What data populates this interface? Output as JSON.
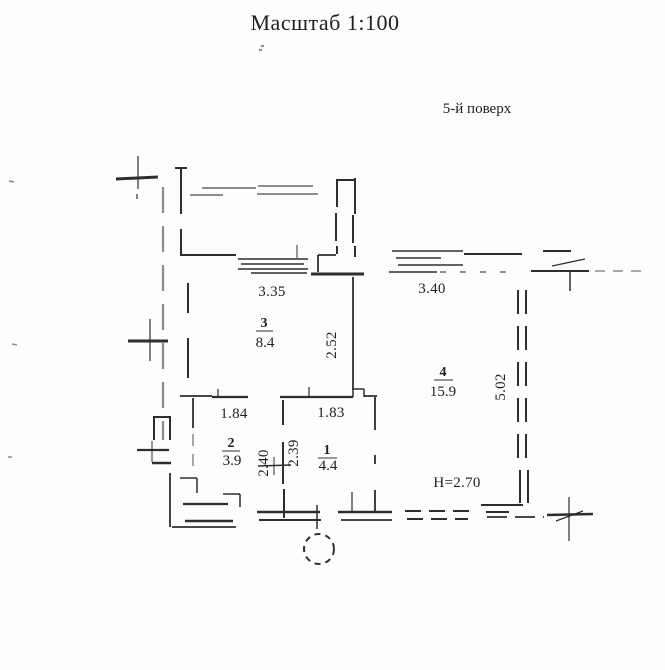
{
  "title": "Масштаб 1:100",
  "floor_label": "5-й поверх",
  "plan": {
    "rooms": {
      "room3": {
        "number": "3",
        "area": "8.4"
      },
      "room4": {
        "number": "4",
        "area": "15.9"
      },
      "room2": {
        "number": "2",
        "area": "3.9"
      },
      "room1": {
        "number": "1",
        "area": "4.4"
      }
    },
    "dimensions": {
      "room3_width": "3.35",
      "room4_width": "3.40",
      "room3_depth": "2.52",
      "room4_depth": "5.02",
      "room2_width": "1.84",
      "room1_width": "1.83",
      "room2_depth": "2.40",
      "room1_depth": "2.39",
      "ceiling_height": "Н=2.70"
    }
  },
  "colors": {
    "ink": "#2e2e2e",
    "faint_ink": "#8c8c8c",
    "paper": "#fdfdfd"
  }
}
